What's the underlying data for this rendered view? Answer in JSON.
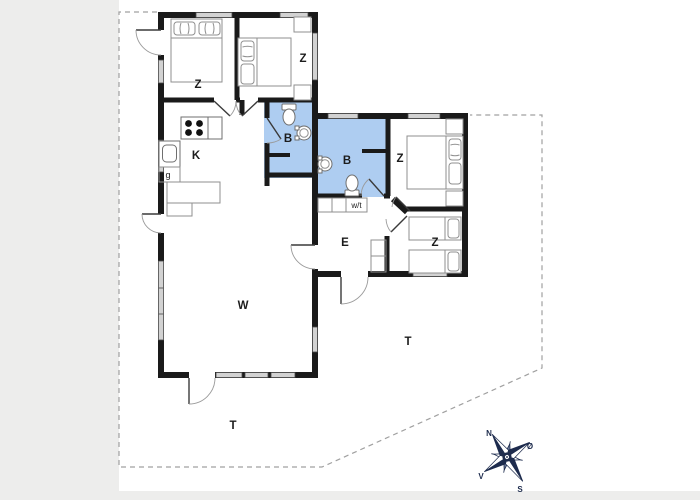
{
  "plan": {
    "room_labels": [
      {
        "name": "bedroom-1",
        "label": "Z"
      },
      {
        "name": "bedroom-2",
        "label": "Z"
      },
      {
        "name": "bedroom-3",
        "label": "Z"
      },
      {
        "name": "bedroom-4",
        "label": "Z"
      },
      {
        "name": "kitchen",
        "label": "K"
      },
      {
        "name": "kitchen-cupboard",
        "label": "g"
      },
      {
        "name": "bathroom-1",
        "label": "B"
      },
      {
        "name": "bathroom-2",
        "label": "B"
      },
      {
        "name": "utility-washer-dryer",
        "label": "w/t"
      },
      {
        "name": "entrance-hall",
        "label": "E"
      },
      {
        "name": "living-room",
        "label": "W"
      },
      {
        "name": "terrace-south",
        "label": "T"
      },
      {
        "name": "terrace-east",
        "label": "T"
      }
    ],
    "compass": {
      "north": "N",
      "east": "Ø",
      "south": "S",
      "west": "V"
    }
  },
  "colors": {
    "bathroom_fill": "#aecdf1",
    "wall": "#1a1a1a",
    "window": "#d2d2d2",
    "boundary_dash": "#a0a0a0",
    "compass_navy": "#1d2b4d",
    "margin_gray": "#ededec"
  }
}
